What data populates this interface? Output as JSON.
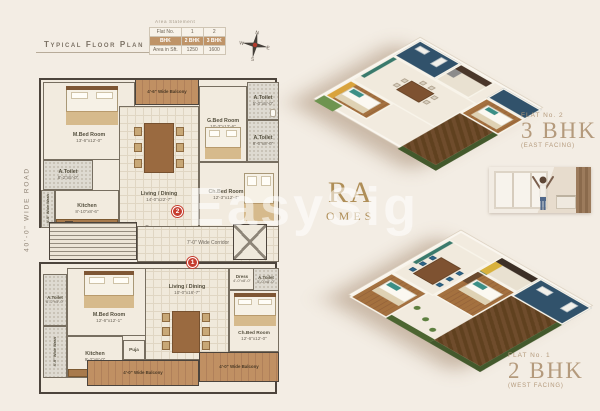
{
  "header": {
    "plan_title": "Typical Floor Plan",
    "area_statement": "Area Statement",
    "table": {
      "rows": [
        [
          "Flat No.",
          "1",
          "2"
        ],
        [
          "BHK",
          "2 BHK",
          "3 BHK"
        ],
        [
          "Area in Sft.",
          "1250",
          "1600"
        ]
      ]
    }
  },
  "compass": {
    "n": "N",
    "e": "E",
    "s": "S",
    "w": "W"
  },
  "road_label": "40'-0\" WIDE ROAD",
  "plan": {
    "upper": {
      "balcony": "4'-6\" Wide Balcony",
      "mbed": {
        "name": "M.Bed Room",
        "dims": "13'-6\"x12'-0\""
      },
      "toilet_a": {
        "name": "A.Toilet",
        "dims": "8'-2\"x5'-0\""
      },
      "kitchen": {
        "name": "Kitchen",
        "dims": "8'-10\"x8'-6\""
      },
      "wash": "4'-0\" Wide Wash",
      "living": {
        "name": "Living / Dining",
        "dims": "14'-0\"x22'-7\""
      },
      "gbed": {
        "name": "G.Bed Room",
        "dims": "10'-3\"x12'-6\""
      },
      "toilet_b": {
        "name": "A.Toilet",
        "dims": "5'-0\"x8'-0\""
      },
      "toilet_c": {
        "name": "A.Toilet",
        "dims": "8'-0\"x8'-0\""
      },
      "chbed": {
        "name": "Ch.Bed Room",
        "dims": "12'-3\"x12'-4\""
      }
    },
    "core": {
      "corridor": "7'-0\" Wide Corridor",
      "dn": "Dn",
      "up": "Up",
      "marker_upper": "2",
      "marker_lower": "1"
    },
    "lower": {
      "mbed": {
        "name": "M.Bed Room",
        "dims": "12'-6\"x12'-1\""
      },
      "toilet_a": {
        "name": "A.Toilet",
        "dims": "8'-2\"x5'-0\""
      },
      "kitchen": {
        "name": "Kitchen",
        "dims": "9'-2\"x8'-0\""
      },
      "wash": "4'-0\" Wide Wash",
      "puja": "Puja",
      "living": {
        "name": "Living / Dining",
        "dims": "10'-0\"x16'-7\""
      },
      "dress": {
        "name": "Dress",
        "dims": "4'-0\"x8'-0\""
      },
      "toilet_b": {
        "name": "A.Toilet",
        "dims": "5'-0\"x8'-0\""
      },
      "chbed": {
        "name": "Ch.Bed Room",
        "dims": "12'-6\"x12'-0\""
      },
      "balcony_1": "4'-0\" Wide Balcony",
      "balcony_2": "4'-0\" Wide Balcony"
    }
  },
  "flats": {
    "east": {
      "no": "FLAT No. 2",
      "bhk": "3 BHK",
      "facing": "(EAST FACING)"
    },
    "west": {
      "no": "FLAT No. 1",
      "bhk": "2 BHK",
      "facing": "(WEST FACING)"
    }
  },
  "watermark": {
    "overlay": "EasySig",
    "brand_line1": "RA",
    "brand_line2": "OMES"
  },
  "colors": {
    "background": "#f3ede4",
    "table_accent": "#bf9468",
    "marker_red": "#c63d2f",
    "gold_label": "#b49a7c",
    "wood": "#b98c5f",
    "navy_bath": "#31526b",
    "hedge_green": "#43592c"
  }
}
